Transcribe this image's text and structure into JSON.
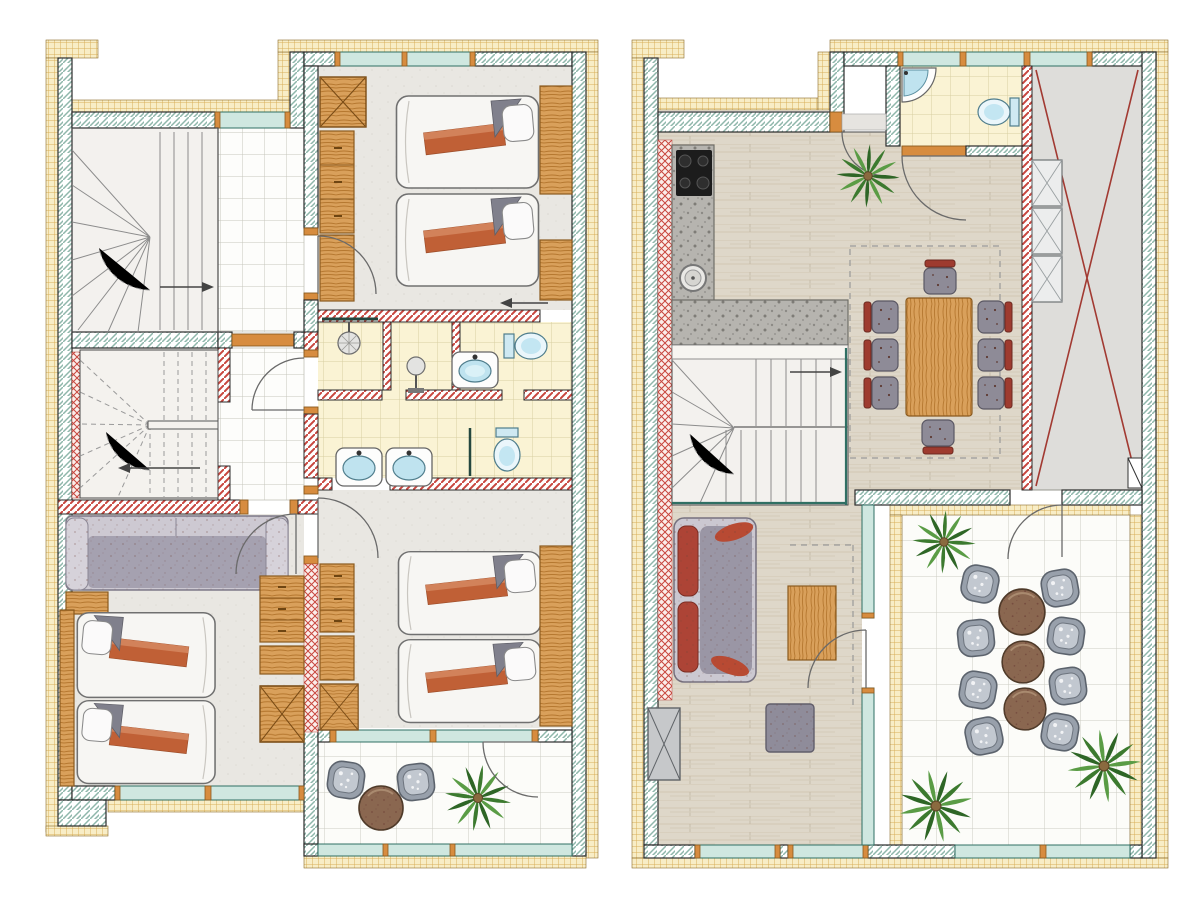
{
  "canvas": {
    "width": 1200,
    "height": 900,
    "background": "#ffffff"
  },
  "drawing_type": "hand-rendered architectural floor plans, two levels side by side, top-down view, no text labels",
  "palette": {
    "exterior_wall_hatch": "#8fb7ab",
    "insulation_fill": "#f8edc6",
    "insulation_grid": "#d8ae59",
    "partition_stripe_red": "#c8463e",
    "window_glass": "#cfe7e0",
    "window_frame_teal": "#2f6f63",
    "door_wood_frame": "#d78c3f",
    "wood_furniture": "#d9a05b",
    "wood_floor": "#ded7c9",
    "granite_counter": "#b6b4af",
    "bedroom_floor": "#e9e7e2",
    "tile_floor_white": "#fdfdfb",
    "bathroom_tile_yellow": "#faf3d4",
    "sanitary_blue": "#bfe3ef",
    "bed_linen_white": "#f7f6f3",
    "blanket_orange": "#c06036",
    "pillow_gray": "#80808c",
    "sofa_gray": "#9a96a5",
    "sofa_cushion_red": "#ad4436",
    "dining_chair_red": "#9e3b2f",
    "patio_chair_gray": "#98a0ab",
    "table_brown": "#8a6750",
    "plant_green": "#3c7a2f",
    "void_cross_red": "#a23a32",
    "void_area_gray": "#deddda",
    "cooktop_black": "#1c1c1c"
  },
  "plans": [
    {
      "name": "upper-floor-plan",
      "position": "left",
      "rooms": [
        {
          "name": "staircase-room-upper",
          "items": [
            "winder-staircase",
            "direction-arrow"
          ]
        },
        {
          "name": "landing",
          "items": [
            "tiled-floor"
          ]
        },
        {
          "name": "bedroom-north",
          "items": [
            "crossed-wardrobe",
            "dresser",
            "cabinet",
            "single-bed",
            "single-bed",
            "headboard-panel",
            "nightstand",
            "entry-arrow",
            "window",
            "door"
          ]
        },
        {
          "name": "shower-room",
          "items": [
            "shower-head",
            "glass-screen"
          ]
        },
        {
          "name": "shower-room-2",
          "items": [
            "standing-shower",
            "washbasin",
            "toilet"
          ]
        },
        {
          "name": "bathroom",
          "items": [
            "washbasin",
            "washbasin",
            "toilet",
            "glass-screen"
          ]
        },
        {
          "name": "hallway",
          "items": [
            "tiled-floor",
            "door",
            "door",
            "door"
          ]
        },
        {
          "name": "staircase-room-lower",
          "items": [
            "winder-staircase-dashed",
            "direction-arrow"
          ]
        },
        {
          "name": "bedroom-southwest",
          "items": [
            "sofa",
            "nightstand",
            "single-bed",
            "single-bed",
            "dresser",
            "crossed-wardrobe",
            "window"
          ]
        },
        {
          "name": "bedroom-southeast",
          "items": [
            "dresser",
            "cabinet",
            "crossed-wardrobe",
            "single-bed",
            "single-bed",
            "headboard-panel",
            "balcony-door"
          ]
        },
        {
          "name": "balcony",
          "items": [
            "patio-chair",
            "patio-chair",
            "round-table",
            "palm-plant",
            "glass-railing"
          ]
        }
      ]
    },
    {
      "name": "ground-floor-plan",
      "position": "right",
      "rooms": [
        {
          "name": "kitchen",
          "items": [
            "cooktop",
            "l-shaped-granite-counter",
            "round-sink",
            "insulated-lining"
          ]
        },
        {
          "name": "entry-hall",
          "items": [
            "entrance-door",
            "palm-plant",
            "wood-floor"
          ]
        },
        {
          "name": "wc",
          "items": [
            "corner-washbasin",
            "toilet",
            "door",
            "window"
          ]
        },
        {
          "name": "void-roof-area",
          "items": [
            "red-cross-marking",
            "stacked-display-cabinet"
          ]
        },
        {
          "name": "dining-area",
          "items": [
            "dining-table",
            "dining-chair",
            "dining-chair",
            "dining-chair",
            "dining-chair",
            "dining-chair",
            "dining-chair",
            "dining-chair",
            "dining-chair",
            "void-dashed-outline"
          ]
        },
        {
          "name": "staircase-room",
          "items": [
            "winder-staircase",
            "direction-arrow",
            "glass-balustrade"
          ]
        },
        {
          "name": "living-area",
          "items": [
            "sofa",
            "coffee-table",
            "pouf",
            "crossed-cabinet",
            "terrace-door",
            "windows"
          ]
        },
        {
          "name": "terrace",
          "items": [
            "patio-chair",
            "patio-chair",
            "patio-chair",
            "patio-chair",
            "patio-chair",
            "patio-chair",
            "patio-chair",
            "patio-chair",
            "round-table",
            "round-table",
            "round-table",
            "palm-plant",
            "palm-plant",
            "palm-plant",
            "glass-railing"
          ]
        }
      ]
    }
  ]
}
